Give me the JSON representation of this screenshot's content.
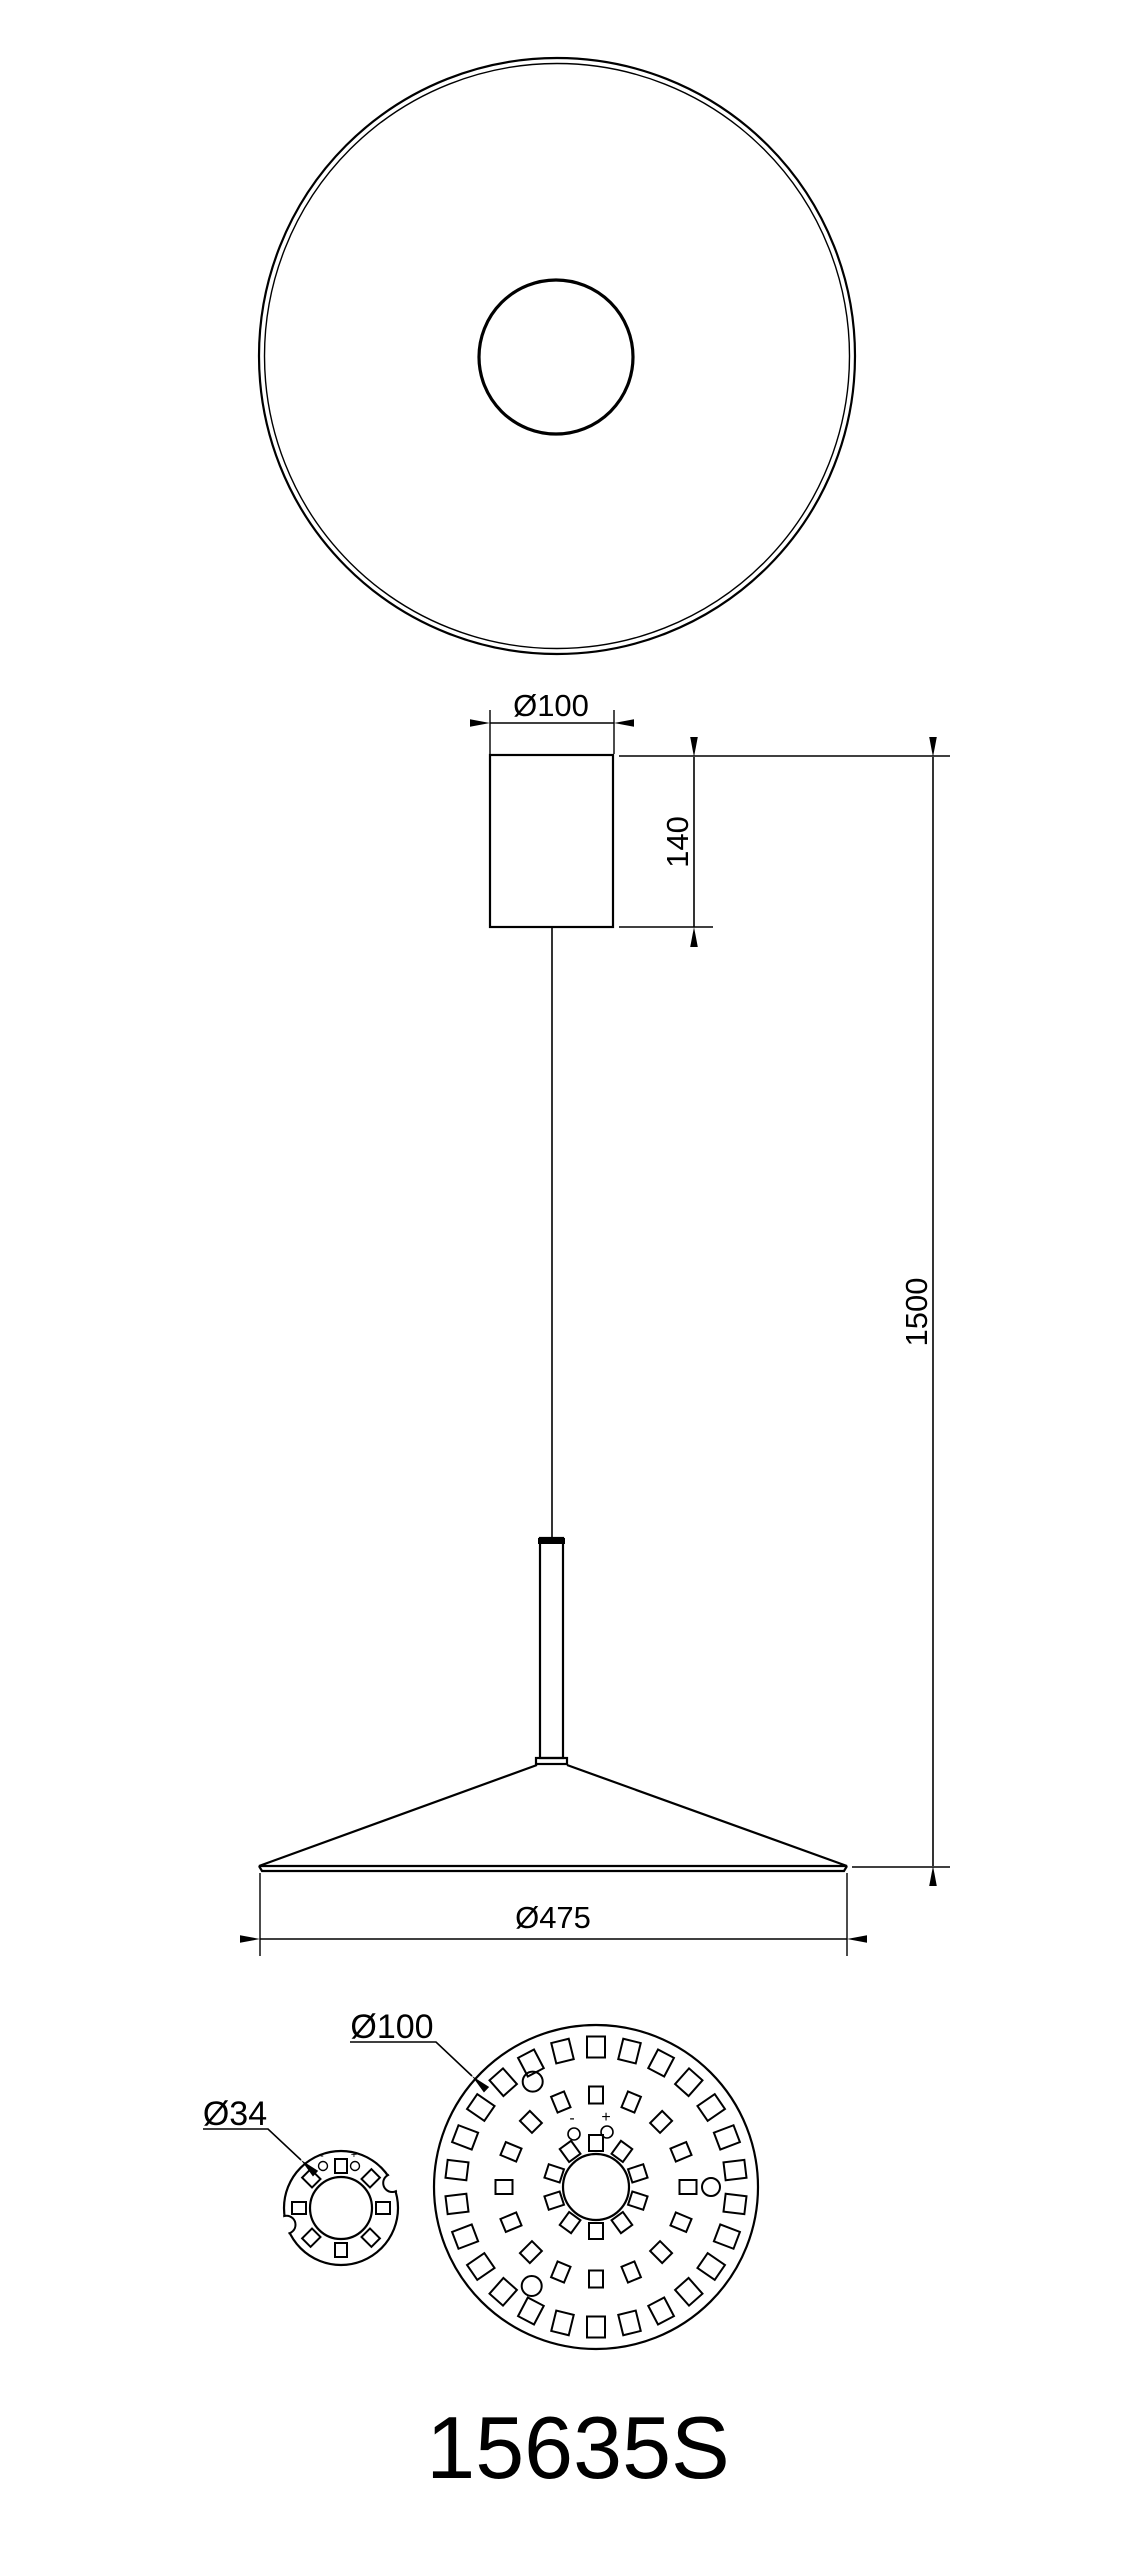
{
  "labels": {
    "canopy_diameter": "Ø100",
    "canopy_height": "140",
    "suspension_length": "1500",
    "shade_diameter": "Ø475",
    "led_board_diameter": "Ø100",
    "adapter_diameter": "Ø34",
    "model_number": "15635S",
    "polarity_plus": "+",
    "polarity_minus": "-"
  },
  "colors": {
    "line": "#000000",
    "background": "#ffffff"
  },
  "led_board": {
    "pad_rings": [
      {
        "count": 10,
        "radius": 44,
        "pad_w": 14,
        "pad_h": 16
      },
      {
        "count": 16,
        "radius": 92,
        "pad_w": 14,
        "pad_h": 17
      },
      {
        "count": 26,
        "radius": 140,
        "pad_w": 18,
        "pad_h": 21
      }
    ],
    "mount_holes": [
      {
        "angle": -31,
        "radius": 123,
        "r": 10
      },
      {
        "angle": 213,
        "radius": 118,
        "r": 10
      },
      {
        "angle": 90,
        "radius": 115,
        "r": 9
      }
    ]
  },
  "adapter_ring": {
    "pad_count": 8,
    "pad_radius": 42,
    "pad_w": 12,
    "pad_h": 14,
    "notches": [
      {
        "angle": 64
      },
      {
        "angle": 253
      }
    ]
  }
}
